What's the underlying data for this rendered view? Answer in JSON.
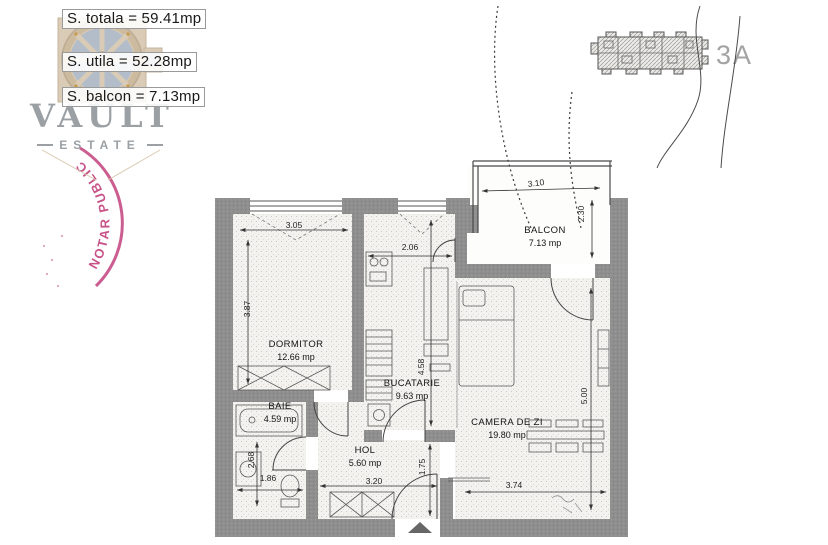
{
  "summary": {
    "lines": [
      "S. totala = 59.41mp",
      "S. utila = 52.28mp",
      "S. balcon = 7.13mp"
    ]
  },
  "branding": {
    "name": "VAULT",
    "subtitle": "ESTATE"
  },
  "stamp": {
    "text": "NOTAR PUBLIC",
    "color": "#c2417c"
  },
  "site_plan": {
    "unit_label": "3A"
  },
  "plan": {
    "rooms": [
      {
        "id": "dormitor",
        "name": "DORMITOR",
        "area": "12.66 mp",
        "width_label": "3.05",
        "height_label": "3.87"
      },
      {
        "id": "bucatarie",
        "name": "BUCATARIE",
        "area": "9.63 mp",
        "width_label": "2.06",
        "height_label": "4.58"
      },
      {
        "id": "camera-de-zi",
        "name": "CAMERA DE ZI",
        "area": "19.80 mp",
        "width_label": "3.74",
        "height_label": "5.00"
      },
      {
        "id": "baie",
        "name": "BAIE",
        "area": "4.59 mp",
        "width_label": "1.86",
        "height_label": "2.68"
      },
      {
        "id": "hol",
        "name": "HOL",
        "area": "5.60 mp",
        "width_label": "3.20",
        "height_label": "1.75"
      },
      {
        "id": "balcon",
        "name": "BALCON",
        "area": "7.13 mp",
        "width_label": "3.10",
        "height_label": "2.30"
      }
    ]
  },
  "colors": {
    "wall_gray": "#8e8e8e",
    "line_dark": "#3c3c3c",
    "brand_gray": "#9ba0a4",
    "stamp_pink": "#c2417c",
    "logo_tan": "#d9cbb6",
    "logo_slate": "#b3bdc9"
  }
}
